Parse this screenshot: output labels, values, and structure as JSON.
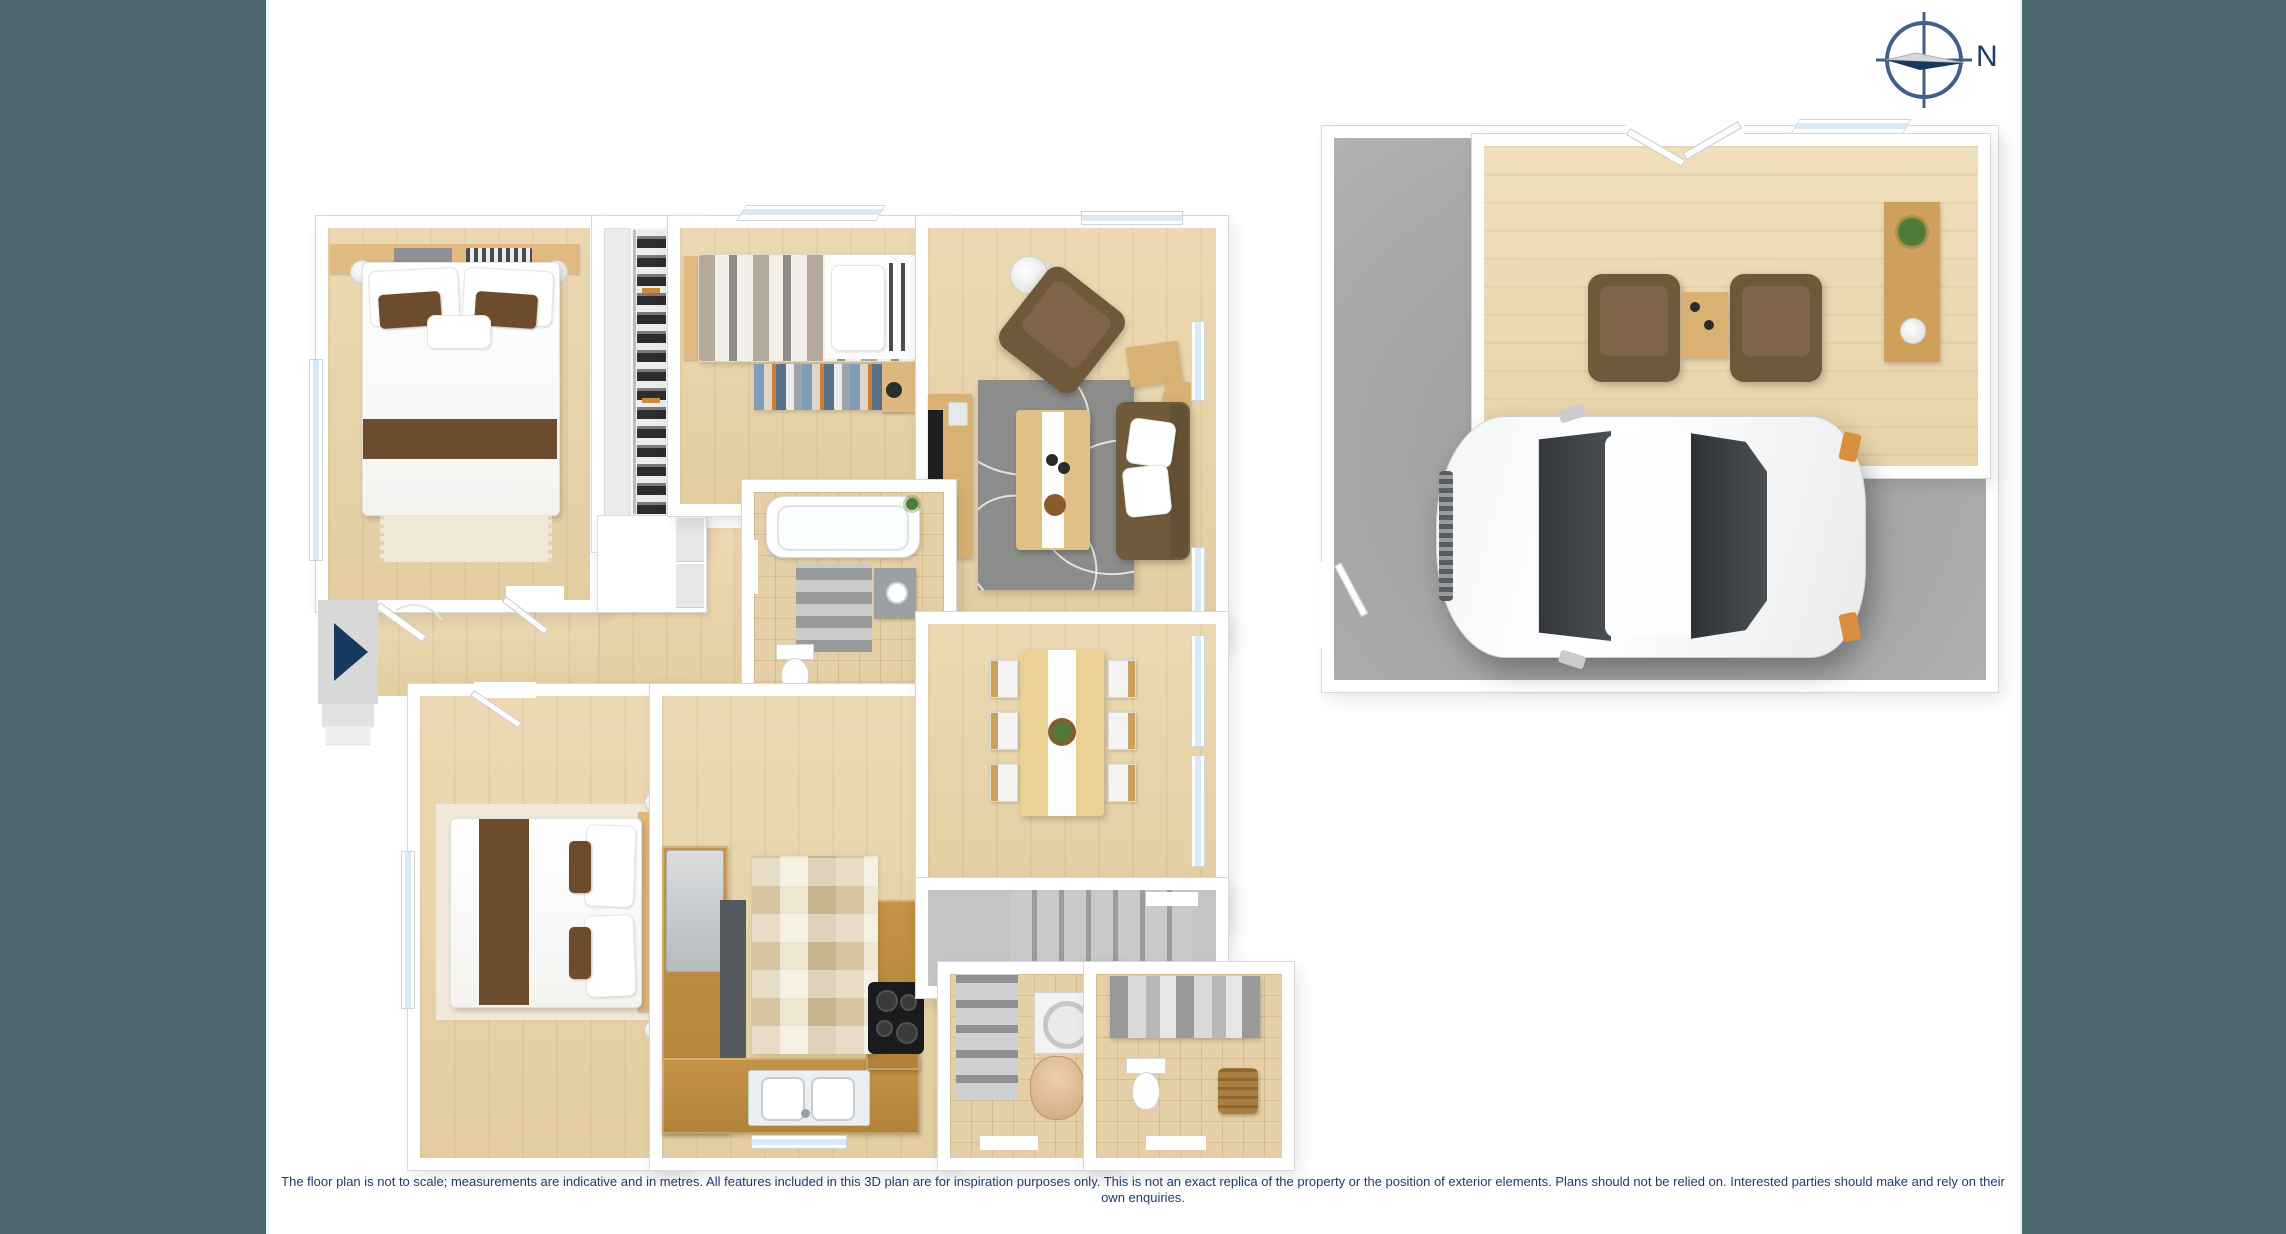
{
  "page": {
    "kind": "3d-floor-plan",
    "background": "#ffffff",
    "side_panel_color": "#4e666e"
  },
  "compass": {
    "label": "N",
    "ring_color": "#41618a",
    "needle_color": "#17395f",
    "needle_light_color": "#d4d8dd",
    "points": "east-right"
  },
  "disclaimer": {
    "text": "The floor plan is not to scale; measurements are indicative and in metres. All features included in this 3D plan are for inspiration purposes only. This is not an exact replica of the property or the position of exterior elements. Plans should not be relied on. Interested parties should make and rely on their own enquiries.",
    "color": "#1d3c6b"
  },
  "palette": {
    "wall": "#ffffff",
    "wood_floor": "#e9d6af",
    "counter_wood": "#b9883f",
    "tile_floor": "#e4cfa6",
    "garage_floor": "#a6a8aa",
    "rug_gray": "#8c8c8a",
    "sofa_brown": "#6f5a3c",
    "accent_brown": "#6d4c2e",
    "window_glass": "#d9e9f5",
    "stairs_gray": "#b6b8ba"
  },
  "plan": {
    "buildings": [
      {
        "name": "main-house",
        "rooms": [
          "master-bedroom",
          "walk-in-wardrobe",
          "bedroom-2",
          "living-room",
          "bathroom",
          "hallway",
          "bedroom-3",
          "kitchen",
          "dining-room",
          "stairwell",
          "laundry",
          "wc"
        ]
      },
      {
        "name": "garage-building",
        "rooms": [
          "rumpus-room",
          "garage"
        ]
      }
    ],
    "entry_marker": "navy-arrow-pointing-right"
  }
}
